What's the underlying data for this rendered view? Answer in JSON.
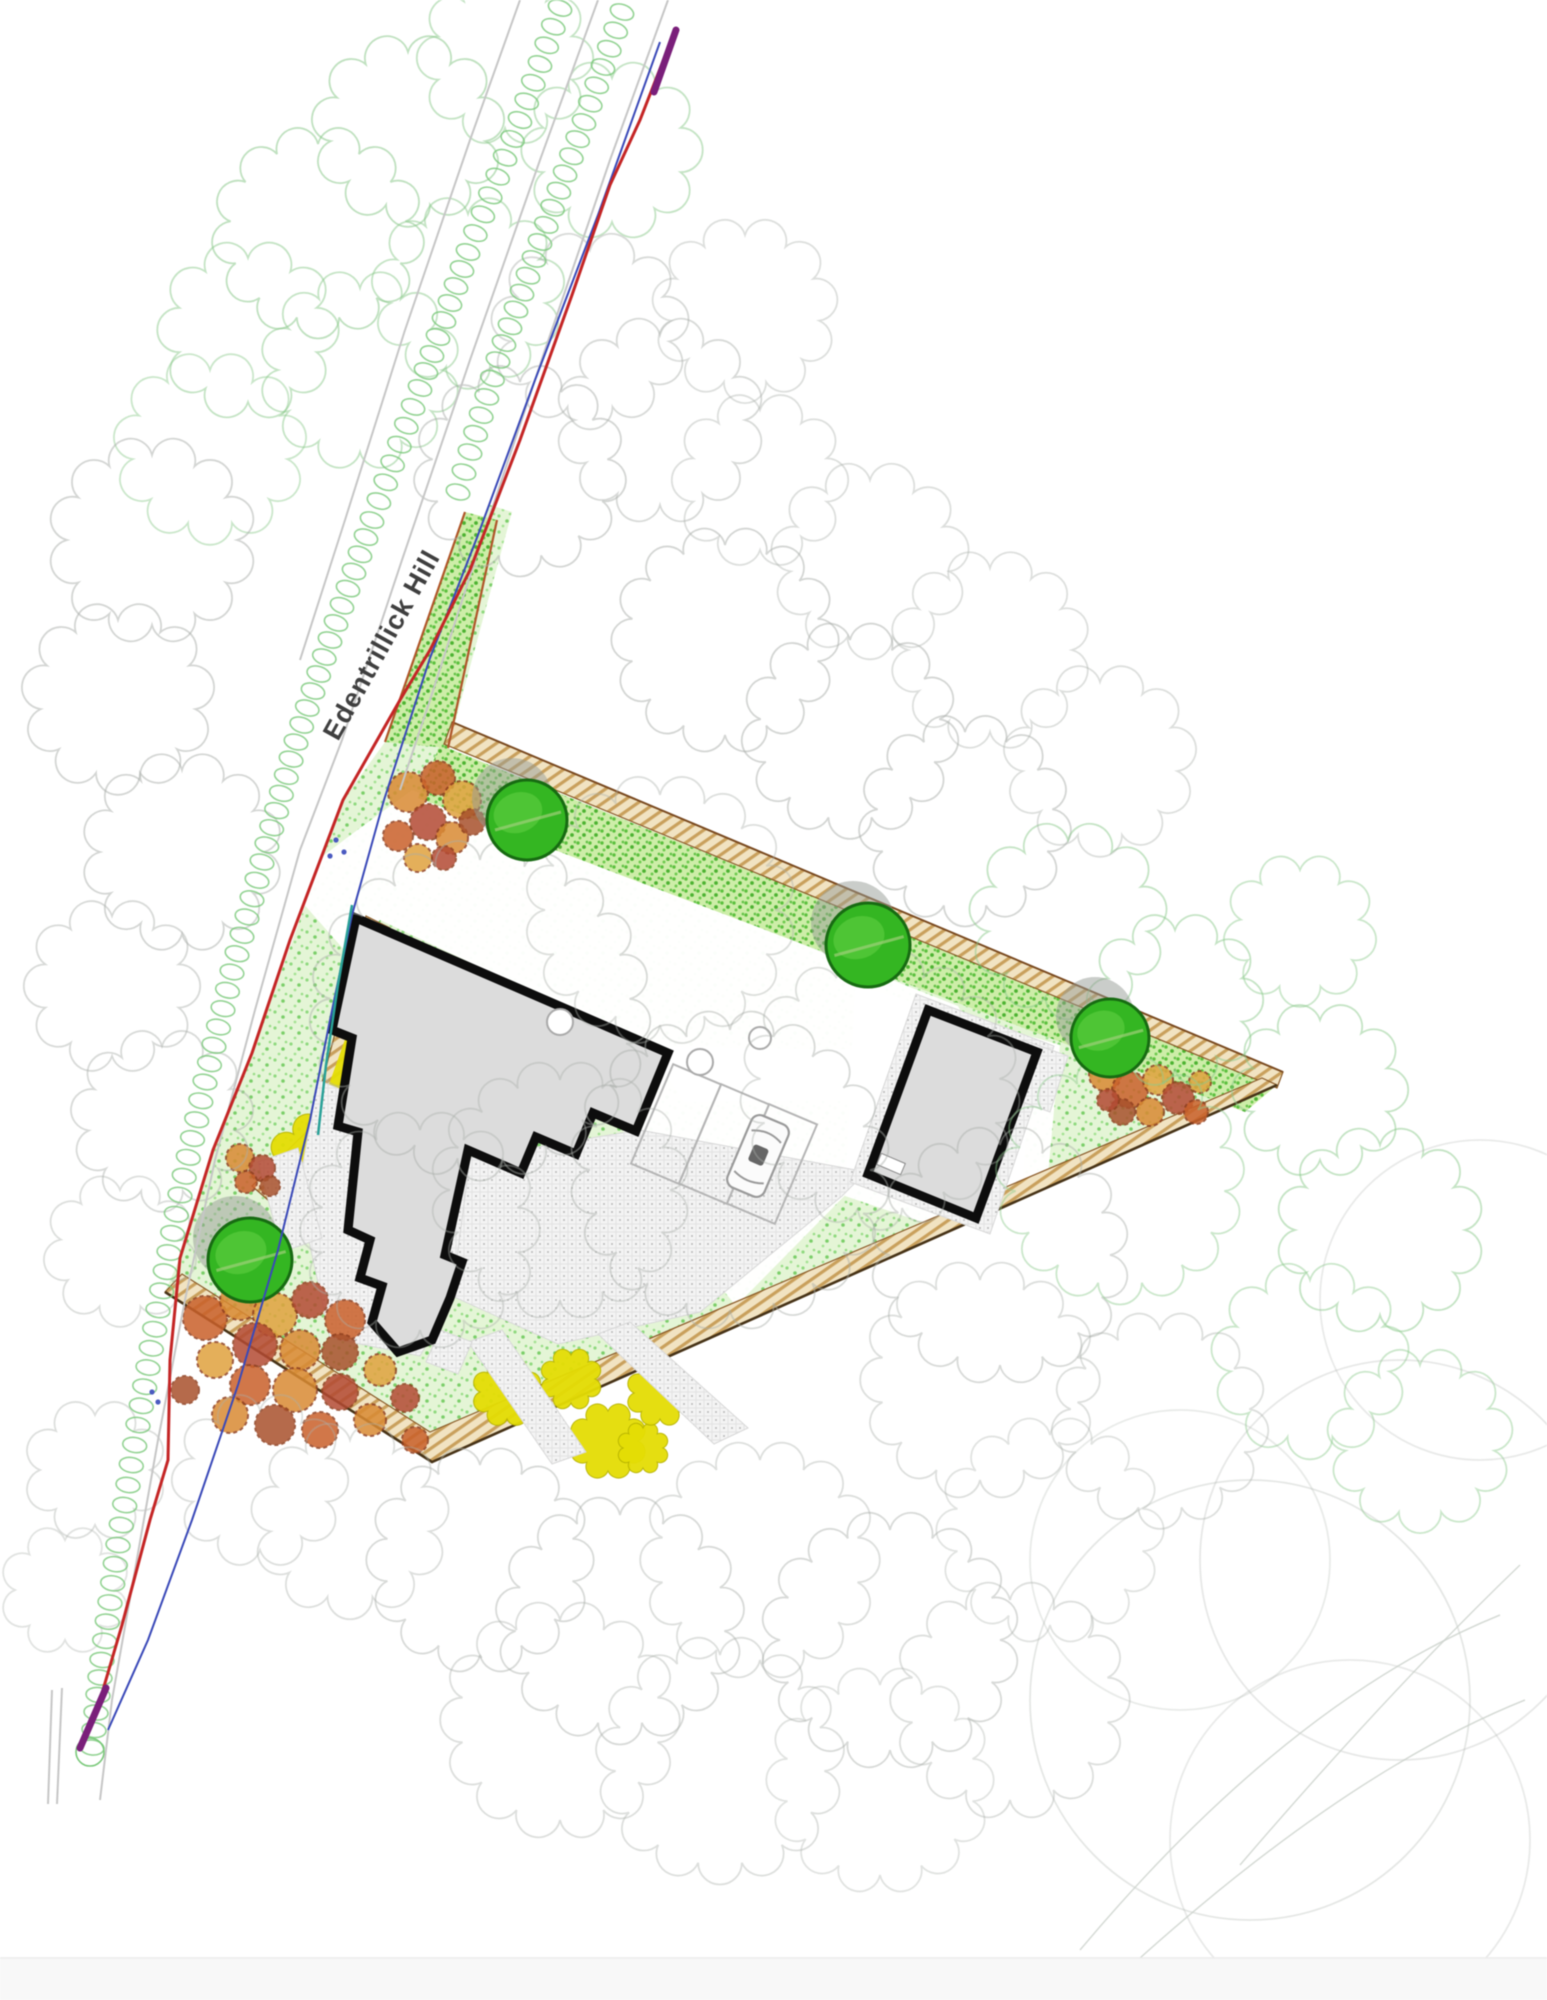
{
  "road": {
    "label": "Edentrillick Hill"
  },
  "palette": {
    "lawn_base": "#e4f5d6",
    "band_base": "#cdeda8",
    "tan_base": "#f1e3c2",
    "yellow": "#e4dd05",
    "house_fill": "#dcdcdc",
    "wall": "#0d0d0d",
    "red_line": "#c42525",
    "blue_line": "#3a49b8",
    "teal_line": "#2aa198",
    "purple_line": "#7a1f7a",
    "tree_fill": "#34b622",
    "tree_ring": "#176b12",
    "canopy_gray": "#a9aea9",
    "canopy_green": "#8cc98c",
    "chain_green": "#79c879",
    "road_gray": "#c6c6c6"
  },
  "site": {
    "outline": [
      [
        490,
        505
      ],
      [
        512,
        512
      ],
      [
        448,
        748
      ],
      [
        1277,
        1085
      ],
      [
        432,
        1462
      ],
      [
        165,
        1292
      ],
      [
        178,
        1262
      ],
      [
        213,
        1150
      ],
      [
        252,
        1053
      ],
      [
        343,
        800
      ],
      [
        385,
        742
      ]
    ],
    "band": [
      [
        440,
        745
      ],
      [
        1277,
        1085
      ],
      [
        1245,
        1112
      ],
      [
        418,
        798
      ]
    ],
    "neck": [
      [
        465,
        512
      ],
      [
        497,
        520
      ],
      [
        448,
        748
      ],
      [
        385,
        742
      ]
    ],
    "tan_north": [
      [
        452,
        722
      ],
      [
        1283,
        1072
      ],
      [
        1277,
        1088
      ],
      [
        444,
        744
      ]
    ],
    "tan_south": [
      [
        165,
        1292
      ],
      [
        432,
        1462
      ],
      [
        1277,
        1085
      ],
      [
        1262,
        1078
      ],
      [
        430,
        1432
      ],
      [
        182,
        1274
      ]
    ],
    "tan_west": [
      [
        366,
        916
      ],
      [
        390,
        928
      ],
      [
        330,
        1140
      ],
      [
        268,
        1200
      ],
      [
        252,
        1186
      ],
      [
        310,
        1128
      ]
    ],
    "south_edge_line": [
      [
        165,
        1292
      ],
      [
        432,
        1462
      ],
      [
        1277,
        1085
      ]
    ],
    "north_edge_line": [
      [
        452,
        722
      ],
      [
        1283,
        1072
      ]
    ],
    "neck_edge_a": [
      [
        465,
        512
      ],
      [
        385,
        742
      ]
    ],
    "neck_edge_b": [
      [
        497,
        520
      ],
      [
        448,
        748
      ]
    ]
  },
  "whites": [
    [
      [
        286,
        884
      ],
      [
        352,
        834
      ],
      [
        412,
        790
      ],
      [
        958,
        1006
      ],
      [
        1006,
        1098
      ],
      [
        684,
        1102
      ],
      [
        648,
        1046
      ],
      [
        380,
        920
      ],
      [
        346,
        952
      ]
    ],
    [
      [
        640,
        1046
      ],
      [
        1032,
        1052
      ],
      [
        1018,
        1248
      ],
      [
        868,
        1172
      ],
      [
        736,
        1306
      ],
      [
        618,
        1160
      ]
    ],
    [
      [
        855,
        985
      ],
      [
        1060,
        1045
      ],
      [
        1040,
        1262
      ],
      [
        845,
        1196
      ]
    ]
  ],
  "paving": [
    [
      [
        318,
        1080
      ],
      [
        430,
        1126
      ],
      [
        472,
        1158
      ],
      [
        452,
        1300
      ],
      [
        420,
        1356
      ],
      [
        330,
        1338
      ],
      [
        298,
        1190
      ]
    ],
    [
      [
        470,
        1158
      ],
      [
        640,
        1130
      ],
      [
        866,
        1172
      ],
      [
        842,
        1196
      ],
      [
        700,
        1312
      ],
      [
        558,
        1344
      ],
      [
        452,
        1296
      ]
    ],
    [
      [
        916,
        994
      ],
      [
        1054,
        1046
      ],
      [
        990,
        1234
      ],
      [
        850,
        1182
      ]
    ],
    [
      [
        1023,
        1040
      ],
      [
        1068,
        1056
      ],
      [
        1050,
        1112
      ],
      [
        1006,
        1096
      ]
    ],
    [
      [
        598,
        1334
      ],
      [
        630,
        1322
      ],
      [
        748,
        1428
      ],
      [
        714,
        1444
      ]
    ],
    [
      [
        468,
        1342
      ],
      [
        502,
        1330
      ],
      [
        586,
        1452
      ],
      [
        552,
        1464
      ]
    ],
    [
      [
        440,
        1330
      ],
      [
        472,
        1342
      ],
      [
        458,
        1374
      ],
      [
        426,
        1362
      ]
    ],
    [
      [
        258,
        1162
      ],
      [
        298,
        1148
      ],
      [
        322,
        1238
      ],
      [
        282,
        1252
      ]
    ]
  ],
  "house": [
    [
      356,
      918
    ],
    [
      668,
      1053
    ],
    [
      636,
      1131
    ],
    [
      593,
      1113
    ],
    [
      576,
      1154
    ],
    [
      536,
      1137
    ],
    [
      521,
      1173
    ],
    [
      468,
      1150
    ],
    [
      445,
      1255
    ],
    [
      462,
      1262
    ],
    [
      450,
      1298
    ],
    [
      432,
      1340
    ],
    [
      398,
      1352
    ],
    [
      372,
      1322
    ],
    [
      382,
      1286
    ],
    [
      360,
      1278
    ],
    [
      370,
      1240
    ],
    [
      348,
      1230
    ],
    [
      358,
      1132
    ],
    [
      338,
      1126
    ],
    [
      352,
      1038
    ],
    [
      332,
      1030
    ]
  ],
  "garage": [
    [
      928,
      1010
    ],
    [
      1037,
      1052
    ],
    [
      976,
      1218
    ],
    [
      868,
      1174
    ]
  ],
  "yellow_strip": [
    [
      384,
      930
    ],
    [
      402,
      940
    ],
    [
      344,
      1098
    ],
    [
      327,
      1090
    ]
  ],
  "beds": [
    {
      "cx": 322,
      "cy": 1168,
      "r": 44
    },
    {
      "cx": 507,
      "cy": 1392,
      "r": 27
    },
    {
      "cx": 571,
      "cy": 1379,
      "r": 24
    },
    {
      "cx": 608,
      "cy": 1441,
      "r": 30
    },
    {
      "cx": 643,
      "cy": 1448,
      "r": 20
    },
    {
      "cx": 660,
      "cy": 1393,
      "r": 26
    }
  ],
  "shrubs": [
    [
      [
        408,
        792,
        20,
        0
      ],
      [
        438,
        778,
        17,
        1
      ],
      [
        462,
        800,
        19,
        3
      ],
      [
        428,
        822,
        18,
        2
      ],
      [
        398,
        836,
        15,
        1
      ],
      [
        452,
        838,
        16,
        0
      ],
      [
        472,
        822,
        13,
        4
      ],
      [
        418,
        858,
        14,
        3
      ],
      [
        444,
        858,
        12,
        2
      ]
    ],
    [
      [
        1105,
        1075,
        16,
        0
      ],
      [
        1130,
        1090,
        18,
        1
      ],
      [
        1158,
        1080,
        15,
        3
      ],
      [
        1178,
        1098,
        16,
        2
      ],
      [
        1150,
        1112,
        14,
        0
      ],
      [
        1122,
        1112,
        13,
        4
      ],
      [
        1196,
        1112,
        12,
        1
      ],
      [
        1200,
        1082,
        11,
        3
      ],
      [
        1108,
        1100,
        11,
        2
      ]
    ],
    [
      [
        205,
        1318,
        22,
        1
      ],
      [
        240,
        1300,
        20,
        0
      ],
      [
        275,
        1315,
        22,
        3
      ],
      [
        310,
        1300,
        18,
        2
      ],
      [
        345,
        1320,
        20,
        1
      ],
      [
        255,
        1345,
        22,
        2
      ],
      [
        300,
        1350,
        20,
        0
      ],
      [
        340,
        1352,
        18,
        4
      ],
      [
        215,
        1360,
        18,
        3
      ],
      [
        250,
        1385,
        20,
        1
      ],
      [
        295,
        1390,
        22,
        0
      ],
      [
        340,
        1392,
        18,
        2
      ],
      [
        380,
        1370,
        16,
        3
      ],
      [
        230,
        1415,
        18,
        0
      ],
      [
        275,
        1425,
        20,
        4
      ],
      [
        320,
        1430,
        18,
        1
      ],
      [
        370,
        1420,
        16,
        0
      ],
      [
        405,
        1398,
        14,
        2
      ],
      [
        415,
        1440,
        13,
        1
      ],
      [
        185,
        1390,
        14,
        4
      ]
    ],
    [
      [
        240,
        1158,
        14,
        0
      ],
      [
        262,
        1168,
        13,
        2
      ],
      [
        246,
        1182,
        11,
        1
      ],
      [
        270,
        1186,
        10,
        4
      ]
    ]
  ],
  "shrub_colors": [
    "#d98a33",
    "#c9602a",
    "#b34a33",
    "#e0a23e",
    "#a8512c"
  ],
  "trees": [
    {
      "cx": 527,
      "cy": 820,
      "r": 40
    },
    {
      "cx": 868,
      "cy": 945,
      "r": 42
    },
    {
      "cx": 1110,
      "cy": 1038,
      "r": 39
    },
    {
      "cx": 250,
      "cy": 1260,
      "r": 42
    }
  ],
  "bays": [
    {
      "cx": 676,
      "cy": 1124,
      "w": 52,
      "h": 108,
      "rot": 23
    },
    {
      "cx": 724,
      "cy": 1144,
      "w": 52,
      "h": 108,
      "rot": 23
    },
    {
      "cx": 772,
      "cy": 1164,
      "w": 52,
      "h": 108,
      "rot": 23
    }
  ],
  "car": {
    "cx": 758,
    "cy": 1156,
    "w": 40,
    "h": 78,
    "rot": 23
  },
  "small_circles": [
    [
      700,
      1062,
      13
    ],
    [
      760,
      1038,
      11
    ],
    [
      560,
      1022,
      13
    ]
  ],
  "chain_west": [
    [
      560,
      8
    ],
    [
      520,
      120
    ],
    [
      468,
      252
    ],
    [
      420,
      388
    ],
    [
      372,
      520
    ],
    [
      330,
      640
    ],
    [
      296,
      742
    ],
    [
      262,
      862
    ],
    [
      232,
      972
    ],
    [
      205,
      1082
    ],
    [
      180,
      1195
    ],
    [
      158,
      1310
    ],
    [
      138,
      1425
    ],
    [
      118,
      1545
    ],
    [
      102,
      1660
    ],
    [
      90,
      1765
    ]
  ],
  "chain_east": [
    [
      622,
      12
    ],
    [
      584,
      122
    ],
    [
      540,
      242
    ],
    [
      498,
      360
    ],
    [
      470,
      452
    ],
    [
      452,
      512
    ]
  ],
  "chain_end_circle": [
    90,
    1752,
    14
  ],
  "road_lines": [
    [
      [
        598,
        0
      ],
      [
        540,
        160
      ],
      [
        470,
        360
      ],
      [
        402,
        560
      ],
      [
        342,
        740
      ],
      [
        300,
        850
      ],
      [
        255,
        1010
      ],
      [
        215,
        1160
      ],
      [
        185,
        1300
      ],
      [
        158,
        1440
      ],
      [
        135,
        1570
      ],
      [
        112,
        1700
      ],
      [
        100,
        1800
      ]
    ],
    [
      [
        668,
        0
      ],
      [
        610,
        160
      ],
      [
        545,
        350
      ],
      [
        480,
        545
      ],
      [
        430,
        700
      ],
      [
        400,
        790
      ]
    ],
    [
      [
        520,
        0
      ],
      [
        470,
        140
      ],
      [
        405,
        330
      ],
      [
        345,
        520
      ],
      [
        300,
        660
      ]
    ],
    [
      [
        52,
        1690
      ],
      [
        48,
        1804
      ]
    ],
    [
      [
        62,
        1688
      ],
      [
        57,
        1804
      ]
    ]
  ],
  "red_line": [
    [
      672,
      38
    ],
    [
      640,
      120
    ],
    [
      610,
      185
    ],
    [
      572,
      295
    ],
    [
      520,
      440
    ],
    [
      470,
      570
    ],
    [
      430,
      650
    ],
    [
      400,
      700
    ],
    [
      343,
      800
    ],
    [
      290,
      940
    ],
    [
      252,
      1053
    ],
    [
      213,
      1150
    ],
    [
      180,
      1258
    ],
    [
      170,
      1360
    ],
    [
      168,
      1460
    ],
    [
      150,
      1520
    ],
    [
      122,
      1625
    ],
    [
      100,
      1700
    ],
    [
      84,
      1738
    ]
  ],
  "blue_line": [
    [
      660,
      42
    ],
    [
      598,
      215
    ],
    [
      535,
      380
    ],
    [
      478,
      535
    ],
    [
      430,
      658
    ],
    [
      384,
      800
    ],
    [
      352,
      915
    ],
    [
      330,
      1020
    ],
    [
      310,
      1120
    ],
    [
      278,
      1250
    ],
    [
      238,
      1385
    ],
    [
      192,
      1520
    ],
    [
      148,
      1640
    ],
    [
      108,
      1730
    ]
  ],
  "teal_line": [
    [
      352,
      905
    ],
    [
      338,
      985
    ],
    [
      326,
      1065
    ],
    [
      318,
      1135
    ]
  ],
  "purple_segs": [
    [
      [
        676,
        30
      ],
      [
        654,
        92
      ]
    ],
    [
      [
        106,
        1688
      ],
      [
        80,
        1748
      ]
    ]
  ],
  "entrance_dots": [
    [
      336,
      840
    ],
    [
      344,
      852
    ],
    [
      330,
      856
    ],
    [
      152,
      1392
    ],
    [
      158,
      1402
    ]
  ],
  "label_pos": {
    "x": 338,
    "y": 742,
    "rot": -61
  },
  "canopies": [
    [
      318,
      232,
      88,
      "g",
      0.55
    ],
    [
      408,
      130,
      78,
      "g",
      0.55
    ],
    [
      505,
      58,
      70,
      "g",
      0.5
    ],
    [
      360,
      370,
      82,
      "g",
      0.5
    ],
    [
      468,
      292,
      78,
      "g",
      0.5
    ],
    [
      248,
      330,
      72,
      "g",
      0.5
    ],
    [
      210,
      448,
      78,
      "g",
      0.45
    ],
    [
      152,
      540,
      85,
      "a",
      0.5
    ],
    [
      118,
      698,
      78,
      "a",
      0.5
    ],
    [
      182,
      852,
      82,
      "a",
      0.5
    ],
    [
      112,
      986,
      70,
      "a",
      0.45
    ],
    [
      162,
      1120,
      74,
      "a",
      0.45
    ],
    [
      120,
      1250,
      60,
      "a",
      0.4
    ],
    [
      612,
      150,
      72,
      "g",
      0.5
    ],
    [
      590,
      330,
      80,
      "a",
      0.45
    ],
    [
      520,
      470,
      88,
      "a",
      0.5
    ],
    [
      660,
      420,
      85,
      "a",
      0.45
    ],
    [
      745,
      310,
      75,
      "a",
      0.4
    ],
    [
      725,
      640,
      95,
      "a",
      0.5
    ],
    [
      850,
      730,
      90,
      "a",
      0.5
    ],
    [
      965,
      820,
      88,
      "a",
      0.5
    ],
    [
      1068,
      920,
      80,
      "g",
      0.5
    ],
    [
      1175,
      1000,
      70,
      "g",
      0.5
    ],
    [
      870,
      560,
      80,
      "a",
      0.4
    ],
    [
      990,
      650,
      82,
      "a",
      0.4
    ],
    [
      1100,
      760,
      78,
      "a",
      0.4
    ],
    [
      760,
      480,
      70,
      "a",
      0.4
    ],
    [
      480,
      1010,
      150,
      "a",
      0.45
    ],
    [
      660,
      910,
      115,
      "a",
      0.4
    ],
    [
      730,
      1170,
      140,
      "a",
      0.45
    ],
    [
      880,
      1090,
      120,
      "a",
      0.4
    ],
    [
      1000,
      1255,
      110,
      "a",
      0.45
    ],
    [
      560,
      1190,
      110,
      "a",
      0.4
    ],
    [
      420,
      1230,
      100,
      "a",
      0.4
    ],
    [
      980,
      1380,
      100,
      "a",
      0.4
    ],
    [
      1120,
      1180,
      105,
      "g",
      0.45
    ],
    [
      1320,
      1090,
      70,
      "g",
      0.5
    ],
    [
      1380,
      1230,
      85,
      "g",
      0.5
    ],
    [
      1310,
      1360,
      80,
      "g",
      0.45
    ],
    [
      1420,
      1440,
      75,
      "g",
      0.45
    ],
    [
      1300,
      930,
      60,
      "g",
      0.45
    ],
    [
      480,
      1560,
      95,
      "a",
      0.45
    ],
    [
      620,
      1620,
      105,
      "a",
      0.45
    ],
    [
      760,
      1560,
      100,
      "a",
      0.4
    ],
    [
      890,
      1640,
      110,
      "a",
      0.45
    ],
    [
      560,
      1720,
      100,
      "a",
      0.4
    ],
    [
      720,
      1760,
      105,
      "a",
      0.4
    ],
    [
      880,
      1780,
      95,
      "a",
      0.35
    ],
    [
      1010,
      1700,
      100,
      "a",
      0.4
    ],
    [
      350,
      1520,
      80,
      "a",
      0.4
    ],
    [
      260,
      1480,
      70,
      "a",
      0.4
    ],
    [
      1050,
      1530,
      95,
      "a",
      0.35
    ],
    [
      1160,
      1420,
      90,
      "a",
      0.4
    ],
    [
      95,
      1470,
      55,
      "a",
      0.4
    ],
    [
      65,
      1590,
      50,
      "a",
      0.35
    ]
  ],
  "big_arcs": [
    [
      1250,
      1700,
      220,
      0.3
    ],
    [
      1400,
      1560,
      200,
      0.28
    ],
    [
      1350,
      1840,
      180,
      0.26
    ],
    [
      1480,
      1300,
      160,
      0.26
    ],
    [
      1180,
      1560,
      150,
      0.25
    ]
  ],
  "contours": [
    "M1080,1950 Q1290,1700 1500,1615",
    "M1140,1958 Q1350,1770 1525,1700",
    "M1240,1865 Q1390,1690 1520,1565"
  ]
}
